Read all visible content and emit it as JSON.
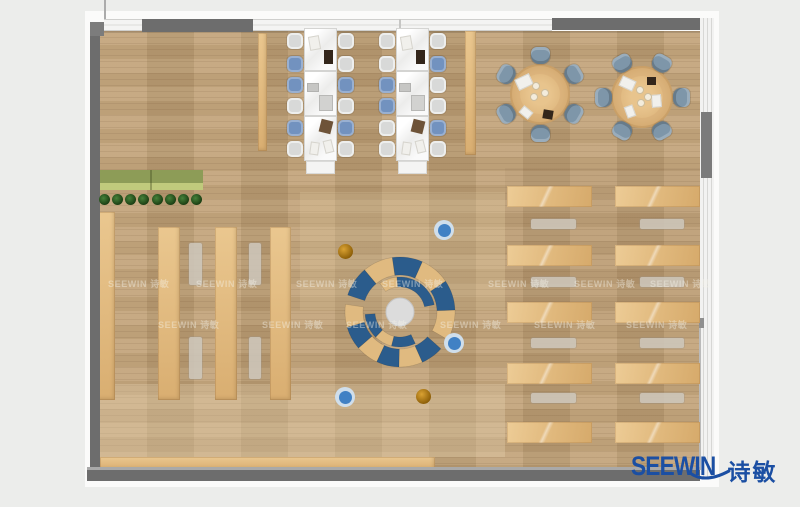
{
  "page": {
    "width": 800,
    "height": 507,
    "bg": "#ecedeb"
  },
  "logo": {
    "text_en": "SEEWIN",
    "text_zh": "诗敏",
    "color": "#1b4fa3"
  },
  "watermark": {
    "text": "SEEWIN 诗敏",
    "rows": [
      {
        "y": 277,
        "xs": [
          108,
          196,
          296,
          382,
          488,
          574,
          650
        ]
      },
      {
        "y": 318,
        "xs": [
          158,
          262,
          346,
          440,
          534,
          626
        ]
      }
    ]
  },
  "colors": {
    "wall": "#6d6d6d",
    "wood": "#c1a176",
    "lounge_blue": "#2b5c8c",
    "lounge_tan": "#e0ba80",
    "chair_blue": "#7292bf",
    "chair_gray": "#d8d9d8",
    "round_chair": "#7e96a9",
    "stool_blue": "#4181c4",
    "stool_orange": "#c08212",
    "plant_green": "#2a5c22",
    "planter_top": "#8d9c57",
    "planter_front": "#c0ca7c",
    "logo_blue": "#1b4fa3"
  },
  "rects": [
    {
      "name": "plan-outer-frame",
      "x": 85,
      "y": 11,
      "w": 634,
      "h": 476,
      "fill": "#fbfbfa"
    },
    {
      "name": "room-floor",
      "x": 100,
      "y": 31,
      "w": 600,
      "h": 439,
      "cls": "floor"
    },
    {
      "name": "floor-shade-top",
      "x": 100,
      "y": 31,
      "w": 600,
      "h": 2,
      "fill": "rgba(0,0,0,0.12)"
    },
    {
      "name": "floor-patch-bottom",
      "x": 100,
      "y": 384,
      "w": 405,
      "h": 73,
      "fill": "rgba(234,216,180,0.32)"
    },
    {
      "name": "floor-patch-mid",
      "x": 300,
      "y": 192,
      "w": 205,
      "h": 118,
      "fill": "rgba(228,209,172,0.20)"
    },
    {
      "name": "floor-patch-right",
      "x": 505,
      "y": 168,
      "w": 195,
      "h": 152,
      "fill": "rgba(110,88,60,0.07)"
    },
    {
      "name": "bookshelf-wall-side",
      "x": 98,
      "y": 212,
      "w": 17,
      "h": 188,
      "cls": "shelf"
    },
    {
      "name": "bookshelf-row-1",
      "x": 158,
      "y": 227,
      "w": 22,
      "h": 173,
      "cls": "shelf"
    },
    {
      "name": "bookshelf-row-2",
      "x": 215,
      "y": 227,
      "w": 22,
      "h": 173,
      "cls": "shelf"
    },
    {
      "name": "bookshelf-row-3",
      "x": 270,
      "y": 227,
      "w": 21,
      "h": 173,
      "cls": "shelf"
    },
    {
      "name": "shelf-pillar-left",
      "x": 258,
      "y": 33,
      "w": 9,
      "h": 118,
      "cls": "shelf"
    },
    {
      "name": "shelf-pillar-right",
      "x": 465,
      "y": 31,
      "w": 11,
      "h": 124,
      "cls": "shelf"
    },
    {
      "name": "bottom-wall-bench",
      "x": 100,
      "y": 457,
      "w": 335,
      "h": 13,
      "cls": "shelf"
    },
    {
      "name": "planter-green-sliver",
      "x": 97,
      "y": 277,
      "w": 3,
      "h": 64,
      "fill": "#8a9a50"
    },
    {
      "name": "reading-bench-1",
      "x": 189,
      "y": 243,
      "w": 13,
      "h": 42,
      "cls": "gbench"
    },
    {
      "name": "reading-bench-2",
      "x": 189,
      "y": 337,
      "w": 13,
      "h": 42,
      "cls": "gbench"
    },
    {
      "name": "reading-bench-3",
      "x": 249,
      "y": 243,
      "w": 12,
      "h": 42,
      "cls": "gbench"
    },
    {
      "name": "reading-bench-4",
      "x": 249,
      "y": 337,
      "w": 12,
      "h": 42,
      "cls": "gbench"
    },
    {
      "name": "planter-top",
      "x": 99,
      "y": 170,
      "w": 104,
      "h": 13,
      "fill": "#8d9c57"
    },
    {
      "name": "planter-front",
      "x": 99,
      "y": 183,
      "w": 104,
      "h": 7,
      "fill": "#c0ca7c"
    },
    {
      "name": "planter-seam",
      "x": 150,
      "y": 170,
      "w": 2,
      "h": 20,
      "fill": "rgba(60,70,30,0.35)"
    },
    {
      "name": "wall-left",
      "x": 90,
      "y": 22,
      "w": 10,
      "h": 450,
      "fill": "#6d6d6d"
    },
    {
      "name": "wall-corner-topleft",
      "x": 90,
      "y": 22,
      "w": 14,
      "h": 14,
      "fill": "#7c7c7c"
    },
    {
      "name": "window-top-left",
      "x": 104,
      "y": 19,
      "w": 38,
      "h": 12,
      "cls": "winH"
    },
    {
      "name": "wall-top-a",
      "x": 142,
      "y": 19,
      "w": 111,
      "h": 13,
      "fill": "#6d6d6d"
    },
    {
      "name": "window-top-main",
      "x": 253,
      "y": 19,
      "w": 299,
      "h": 12,
      "cls": "winH"
    },
    {
      "name": "wall-top-b",
      "x": 552,
      "y": 18,
      "w": 160,
      "h": 12,
      "fill": "#6d6d6d"
    },
    {
      "name": "window-wall-right",
      "x": 700,
      "y": 18,
      "w": 14,
      "h": 460,
      "cls": "winV"
    },
    {
      "name": "wall-pier-right",
      "x": 701,
      "y": 112,
      "w": 11,
      "h": 66,
      "fill": "#7b7b7b"
    },
    {
      "name": "wall-notch-right",
      "x": 699,
      "y": 318,
      "w": 5,
      "h": 10,
      "fill": "#909090"
    },
    {
      "name": "wall-edge-right",
      "x": 699,
      "y": 328,
      "w": 2,
      "h": 142,
      "fill": "#bababa"
    },
    {
      "name": "wall-bottom-highlight",
      "x": 87,
      "y": 467,
      "w": 613,
      "h": 3,
      "fill": "#a9a9a9"
    },
    {
      "name": "wall-bottom",
      "x": 87,
      "y": 470,
      "w": 613,
      "h": 11,
      "fill": "#6d6d6d"
    },
    {
      "name": "mullion-line-a",
      "x": 104,
      "y": 0,
      "w": 2,
      "h": 19,
      "fill": "#ababab"
    },
    {
      "name": "mullion-line-b",
      "x": 399,
      "y": 19,
      "w": 2,
      "h": 12,
      "fill": "#c6c6c4"
    }
  ],
  "plants": {
    "cy": 199,
    "r": 5.5,
    "cxs": [
      104,
      117,
      130,
      143,
      157,
      170,
      183,
      196
    ]
  },
  "desk_area": {
    "desk_h": 21,
    "bench_h": 10,
    "desk_ys": [
      186,
      245,
      302,
      363,
      422
    ],
    "bench_ys": [
      219,
      277,
      338,
      393
    ],
    "cols": [
      {
        "x": 507,
        "w": 85,
        "bx": 531,
        "bw": 45
      },
      {
        "x": 615,
        "w": 85,
        "bx": 640,
        "bw": 44
      }
    ]
  },
  "clusters": {
    "desk_w": 33,
    "modules": [
      [
        28,
        43
      ],
      [
        71,
        45
      ],
      [
        116,
        45
      ]
    ],
    "cabinet_y": 161,
    "chair_ys": [
      33,
      56,
      77,
      98,
      120,
      141
    ],
    "units": [
      {
        "dx": 304,
        "left": [
          "g",
          "b",
          "b",
          "g",
          "b",
          "g"
        ],
        "right": [
          "g",
          "g",
          "b",
          "g",
          "b",
          "g"
        ]
      },
      {
        "dx": 396,
        "left": [
          "g",
          "g",
          "b",
          "b",
          "g",
          "g"
        ],
        "right": [
          "g",
          "b",
          "g",
          "g",
          "b",
          "g"
        ]
      }
    ],
    "items": [
      {
        "ox": 5,
        "y": 36,
        "w": 11,
        "h": 14,
        "rot": -10,
        "c": "paper"
      },
      {
        "ox": 20,
        "y": 50,
        "w": 9,
        "h": 14,
        "rot": 0,
        "c": "dark"
      },
      {
        "ox": 3,
        "y": 83,
        "w": 12,
        "h": 9,
        "rot": 0,
        "c": "panel"
      },
      {
        "ox": 15,
        "y": 95,
        "w": 14,
        "h": 16,
        "rot": 0,
        "c": "box"
      },
      {
        "ox": 16,
        "y": 120,
        "w": 12,
        "h": 13,
        "rot": 14,
        "c": "brown"
      },
      {
        "ox": 6,
        "y": 142,
        "w": 9,
        "h": 13,
        "rot": 8,
        "c": "paper"
      },
      {
        "ox": 20,
        "y": 140,
        "w": 9,
        "h": 13,
        "rot": -14,
        "c": "paper"
      }
    ]
  },
  "round_tables": {
    "chair_dist": 39,
    "chair_w": 19,
    "chair_h": 17,
    "tables": [
      {
        "cx": 540,
        "cy": 94,
        "r": 30,
        "start": 30,
        "items": [
          {
            "dx": -16,
            "dy": -12,
            "w": 16,
            "h": 12,
            "rot": -25,
            "c": "paper"
          },
          {
            "dx": 8,
            "dy": 20,
            "w": 10,
            "h": 9,
            "rot": 10,
            "c": "dark"
          },
          {
            "dx": -14,
            "dy": 18,
            "w": 12,
            "h": 9,
            "rot": 40,
            "c": "paper"
          },
          {
            "dx": -4,
            "dy": -8,
            "c": "plate"
          },
          {
            "dx": 5,
            "dy": -1,
            "c": "plate"
          },
          {
            "dx": -6,
            "dy": 3,
            "c": "plate"
          }
        ]
      },
      {
        "cx": 642,
        "cy": 97,
        "r": 31,
        "start": 0,
        "items": [
          {
            "dx": -15,
            "dy": -14,
            "w": 15,
            "h": 11,
            "rot": 25,
            "c": "paper"
          },
          {
            "dx": 14,
            "dy": 4,
            "w": 13,
            "h": 10,
            "rot": 85,
            "c": "paper"
          },
          {
            "dx": 9,
            "dy": -16,
            "w": 9,
            "h": 8,
            "rot": 0,
            "c": "dark"
          },
          {
            "dx": -12,
            "dy": 14,
            "w": 12,
            "h": 9,
            "rot": 70,
            "c": "paper"
          },
          {
            "dx": -2,
            "dy": -7,
            "c": "plate"
          },
          {
            "dx": 6,
            "dy": 0,
            "c": "plate"
          },
          {
            "dx": -1,
            "dy": 6,
            "c": "plate"
          }
        ]
      }
    ]
  },
  "lounge": {
    "cx": 400,
    "cy": 312,
    "center_r": 14,
    "box": {
      "x": 325,
      "y": 237,
      "w": 150,
      "h": 150
    },
    "arcs": [
      [
        37,
        55,
        162,
        130,
        "b"
      ],
      [
        37,
        55,
        130,
        98,
        "t"
      ],
      [
        37,
        55,
        98,
        66,
        "b"
      ],
      [
        37,
        55,
        66,
        34,
        "t"
      ],
      [
        37,
        55,
        34,
        2,
        "b"
      ],
      [
        37,
        55,
        2,
        -30,
        "t"
      ],
      [
        37,
        55,
        172,
        196,
        "t"
      ],
      [
        37,
        55,
        196,
        221,
        "b"
      ],
      [
        37,
        55,
        221,
        245,
        "t"
      ],
      [
        37,
        55,
        245,
        269,
        "b"
      ],
      [
        37,
        55,
        269,
        294,
        "t"
      ],
      [
        37,
        55,
        294,
        318,
        "b"
      ],
      [
        25,
        35,
        125,
        95,
        "t"
      ],
      [
        25,
        35,
        95,
        12,
        "b"
      ],
      [
        25,
        35,
        184,
        226,
        "b"
      ],
      [
        25,
        35,
        226,
        256,
        "t"
      ],
      [
        25,
        35,
        256,
        296,
        "b"
      ]
    ]
  },
  "stools": [
    {
      "x": 444,
      "y": 230,
      "c": "blue"
    },
    {
      "x": 454,
      "y": 343,
      "c": "blue"
    },
    {
      "x": 345,
      "y": 397,
      "c": "blue"
    },
    {
      "x": 345,
      "y": 251,
      "c": "orange"
    },
    {
      "x": 423,
      "y": 396,
      "c": "orange"
    }
  ]
}
